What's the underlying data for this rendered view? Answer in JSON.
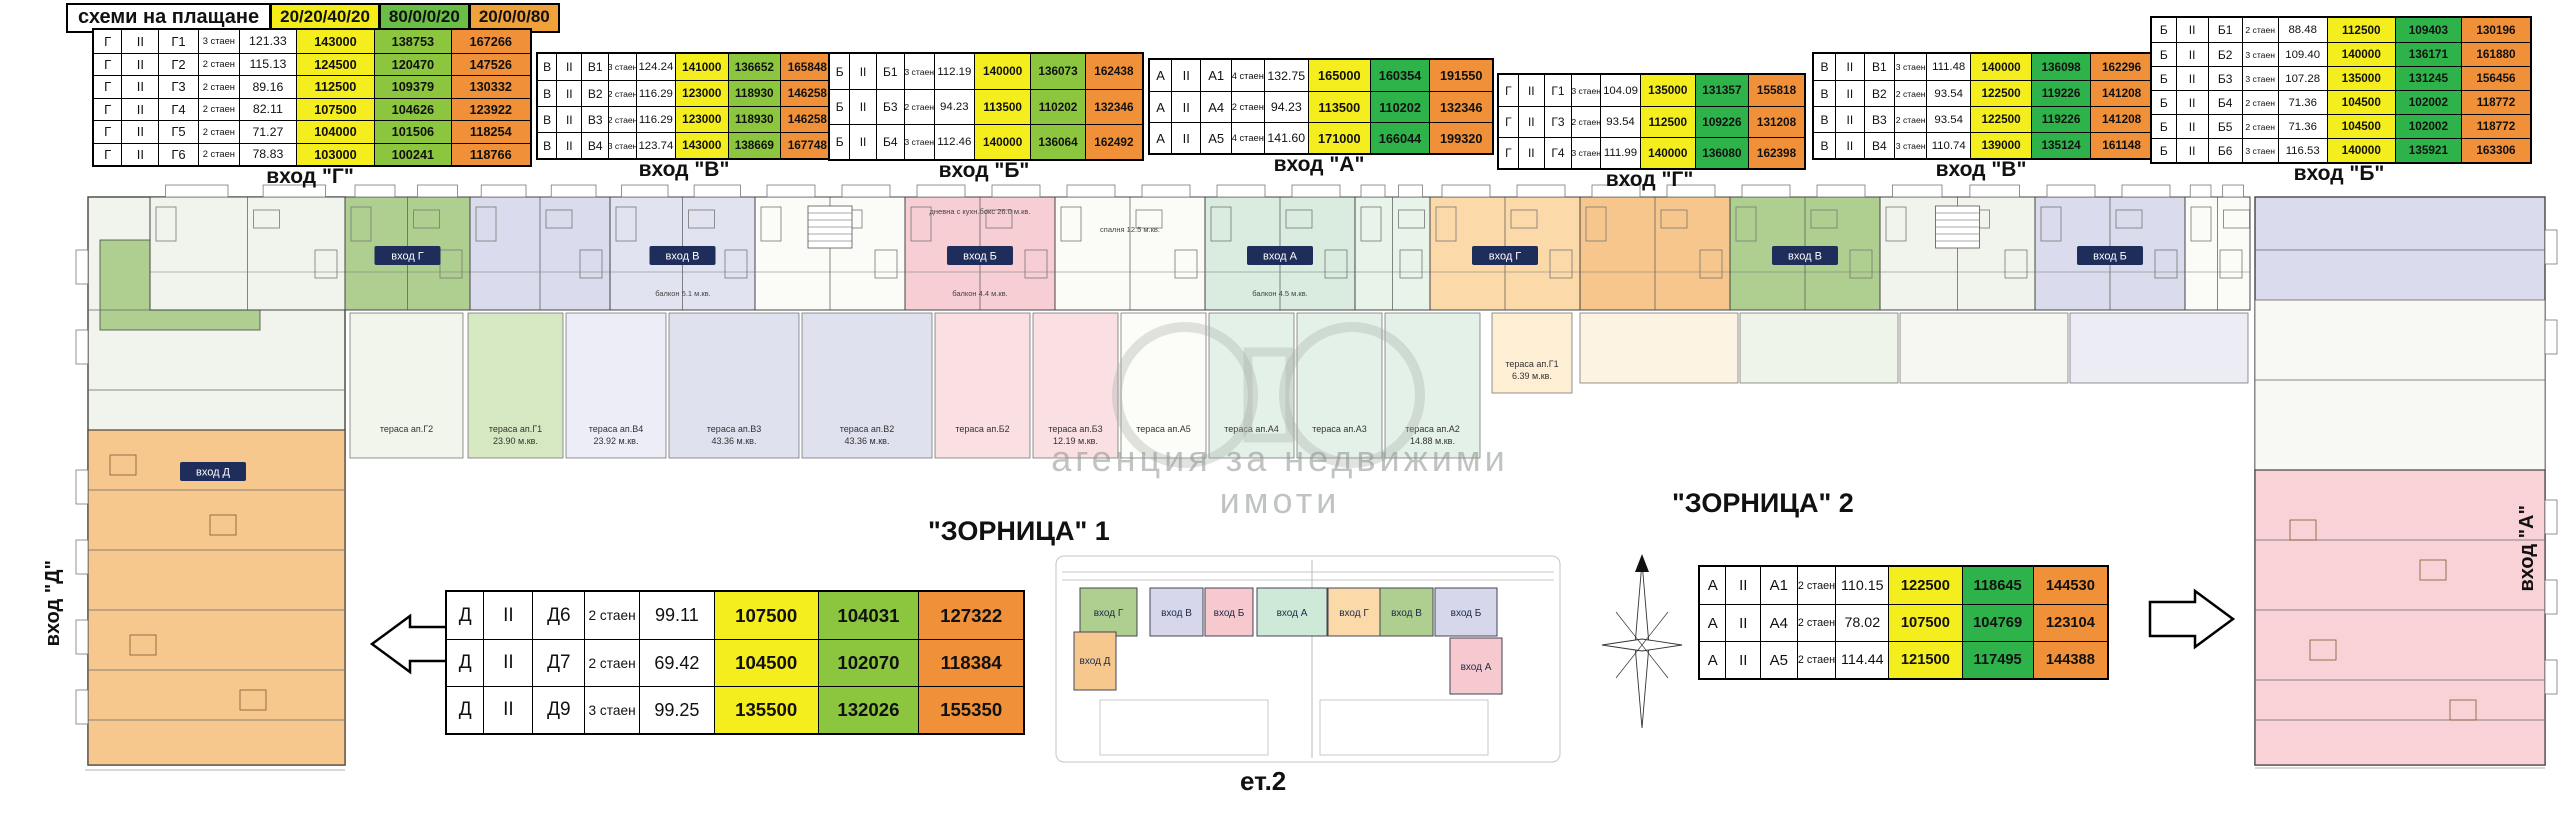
{
  "header": {
    "title": "схеми на плащане",
    "schemes": [
      {
        "label": "20/20/40/20",
        "color": "#f3ec19"
      },
      {
        "label": "80/0/0/20",
        "color": "#6abd45"
      },
      {
        "label": "20/0/0/80",
        "color": "#f0a13a"
      }
    ]
  },
  "colors": {
    "yellow": "#f5ee1e",
    "green_light": "#8cc63f",
    "green_dark": "#2eb34a",
    "orange": "#f0913a",
    "navy": "#1f2d5a"
  },
  "price_tables": [
    {
      "id": "g-left",
      "entrance": "вход \"Г\"",
      "green": "light",
      "x": 92,
      "y": 28,
      "w": 436,
      "row_h": 22.5,
      "fs": 13,
      "rows": [
        [
          "Г",
          "II",
          "Г1",
          "3 стаен",
          "121.33",
          "143000",
          "138753",
          "167266"
        ],
        [
          "Г",
          "II",
          "Г2",
          "2 стаен",
          "115.13",
          "124500",
          "120470",
          "147526"
        ],
        [
          "Г",
          "II",
          "Г3",
          "2 стаен",
          "89.16",
          "112500",
          "109379",
          "130332"
        ],
        [
          "Г",
          "II",
          "Г4",
          "2 стаен",
          "82.11",
          "107500",
          "104626",
          "123922"
        ],
        [
          "Г",
          "II",
          "Г5",
          "2 стаен",
          "71.27",
          "104000",
          "101506",
          "118254"
        ],
        [
          "Г",
          "II",
          "Г6",
          "2 стаен",
          "78.83",
          "103000",
          "100241",
          "118766"
        ]
      ]
    },
    {
      "id": "v-left",
      "entrance": "вход \"В\"",
      "green": "light",
      "x": 536,
      "y": 52,
      "w": 296,
      "row_h": 26,
      "fs": 12,
      "rows": [
        [
          "В",
          "II",
          "В1",
          "3 стаен",
          "124.24",
          "141000",
          "136652",
          "165848"
        ],
        [
          "В",
          "II",
          "В2",
          "2 стаен",
          "116.29",
          "123000",
          "118930",
          "146258"
        ],
        [
          "В",
          "II",
          "В3",
          "2 стаен",
          "116.29",
          "123000",
          "118930",
          "146258"
        ],
        [
          "В",
          "II",
          "В4",
          "3 стаен",
          "123.74",
          "143000",
          "138669",
          "167748"
        ]
      ]
    },
    {
      "id": "b-left",
      "entrance": "вход \"Б\"",
      "green": "light",
      "x": 828,
      "y": 52,
      "w": 312,
      "row_h": 35,
      "fs": 12,
      "rows": [
        [
          "Б",
          "II",
          "Б1",
          "3 стаен",
          "112.19",
          "140000",
          "136073",
          "162438"
        ],
        [
          "Б",
          "II",
          "Б3",
          "2 стаен",
          "94.23",
          "113500",
          "110202",
          "132346"
        ],
        [
          "Б",
          "II",
          "Б4",
          "3 стаен",
          "112.46",
          "140000",
          "136064",
          "162492"
        ]
      ]
    },
    {
      "id": "a-top",
      "entrance": "вход \"А\"",
      "green": "dark",
      "x": 1148,
      "y": 58,
      "w": 342,
      "row_h": 31,
      "fs": 13,
      "rows": [
        [
          "А",
          "II",
          "А1",
          "4 стаен",
          "132.75",
          "165000",
          "160354",
          "191550"
        ],
        [
          "А",
          "II",
          "А4",
          "2 стаен",
          "94.23",
          "113500",
          "110202",
          "132346"
        ],
        [
          "А",
          "II",
          "А5",
          "4 стаен",
          "141.60",
          "171000",
          "166044",
          "199320"
        ]
      ]
    },
    {
      "id": "g-right",
      "entrance": "вход \"Г\"",
      "green": "dark",
      "x": 1497,
      "y": 73,
      "w": 305,
      "row_h": 31,
      "fs": 12,
      "rows": [
        [
          "Г",
          "II",
          "Г1",
          "3 стаен",
          "104.09",
          "135000",
          "131357",
          "155818"
        ],
        [
          "Г",
          "II",
          "Г3",
          "2 стаен",
          "93.54",
          "112500",
          "109226",
          "131208"
        ],
        [
          "Г",
          "II",
          "Г4",
          "3 стаен",
          "111.99",
          "140000",
          "136080",
          "162398"
        ]
      ]
    },
    {
      "id": "v-right",
      "entrance": "вход \"В\"",
      "green": "dark",
      "x": 1812,
      "y": 52,
      "w": 338,
      "row_h": 26,
      "fs": 12,
      "rows": [
        [
          "В",
          "II",
          "В1",
          "3 стаен",
          "111.48",
          "140000",
          "136098",
          "162296"
        ],
        [
          "В",
          "II",
          "В2",
          "2 стаен",
          "93.54",
          "122500",
          "119226",
          "141208"
        ],
        [
          "В",
          "II",
          "В3",
          "2 стаен",
          "93.54",
          "122500",
          "119226",
          "141208"
        ],
        [
          "В",
          "II",
          "В4",
          "3 стаен",
          "110.74",
          "139000",
          "135124",
          "161148"
        ]
      ]
    },
    {
      "id": "b-right",
      "entrance": "вход \"Б\"",
      "green": "dark",
      "x": 2150,
      "y": 16,
      "w": 378,
      "row_h": 24,
      "fs": 12,
      "rows": [
        [
          "Б",
          "II",
          "Б1",
          "2 стаен",
          "88.48",
          "112500",
          "109403",
          "130196"
        ],
        [
          "Б",
          "II",
          "Б2",
          "3 стаен",
          "109.40",
          "140000",
          "136171",
          "161880"
        ],
        [
          "Б",
          "II",
          "Б3",
          "3 стаен",
          "107.28",
          "135000",
          "131245",
          "156456"
        ],
        [
          "Б",
          "II",
          "Б4",
          "2 стаен",
          "71.36",
          "104500",
          "102002",
          "118772"
        ],
        [
          "Б",
          "II",
          "Б5",
          "2 стаен",
          "71.36",
          "104500",
          "102002",
          "118772"
        ],
        [
          "Б",
          "II",
          "Б6",
          "3 стаен",
          "116.53",
          "140000",
          "135921",
          "163306"
        ]
      ]
    },
    {
      "id": "d-bottom",
      "entrance": "",
      "green": "light",
      "x": 445,
      "y": 590,
      "w": 576,
      "row_h": 47,
      "fs": 19,
      "rows": [
        [
          "Д",
          "II",
          "Д6",
          "2 стаен",
          "99.11",
          "107500",
          "104031",
          "127322"
        ],
        [
          "Д",
          "II",
          "Д7",
          "2 стаен",
          "69.42",
          "104500",
          "102070",
          "118384"
        ],
        [
          "Д",
          "II",
          "Д9",
          "3 стаен",
          "99.25",
          "135500",
          "132026",
          "155350"
        ]
      ]
    },
    {
      "id": "a-bottom",
      "entrance": "",
      "green": "dark",
      "x": 1698,
      "y": 565,
      "w": 407,
      "row_h": 37,
      "fs": 15,
      "rows": [
        [
          "А",
          "II",
          "А1",
          "2 стаен",
          "110.15",
          "122500",
          "118645",
          "144530"
        ],
        [
          "А",
          "II",
          "А4",
          "2 стаен",
          "78.02",
          "107500",
          "104769",
          "123104"
        ],
        [
          "А",
          "II",
          "А5",
          "2 стаен",
          "114.44",
          "121500",
          "117495",
          "144388"
        ]
      ]
    }
  ],
  "labels": {
    "zornitsa1": "\"ЗОРНИЦА\" 1",
    "zornitsa2": "\"ЗОРНИЦА\" 2",
    "floor": "ет.2",
    "wing_left": "вход \"Д\"",
    "wing_right": "вход \"А\"",
    "watermark": "агенция за недвижими имоти"
  },
  "plan": {
    "palette": {
      "pale": "#f1f4ec",
      "green": "#aecf90",
      "lavender": "#dadbec",
      "lavender2": "#e2e3f0",
      "white": "#fbfbf8",
      "pink": "#f6ced3",
      "mint": "#d9ecdf",
      "mint2": "#e8f3ea",
      "tan": "#fbd9a8",
      "orange": "#f6c68c",
      "wing_orange": "#f7c88e",
      "wing_pink": "#f8d2d6",
      "line": "#444444"
    },
    "band_segments": [
      {
        "x": 150,
        "w": 195,
        "color": "pale",
        "label": ""
      },
      {
        "x": 345,
        "w": 125,
        "color": "green",
        "label": "вход Г"
      },
      {
        "x": 470,
        "w": 140,
        "color": "lavender",
        "label": ""
      },
      {
        "x": 610,
        "w": 145,
        "color": "lavender2",
        "label": "вход В"
      },
      {
        "x": 755,
        "w": 150,
        "color": "white",
        "label": "",
        "stair": true
      },
      {
        "x": 905,
        "w": 150,
        "color": "pink",
        "label": "вход Б"
      },
      {
        "x": 1055,
        "w": 150,
        "color": "white",
        "label": ""
      },
      {
        "x": 1205,
        "w": 150,
        "color": "mint",
        "label": "вход А"
      },
      {
        "x": 1355,
        "w": 75,
        "color": "mint2",
        "label": ""
      },
      {
        "x": 1430,
        "w": 150,
        "color": "tan",
        "label": "вход Г"
      },
      {
        "x": 1580,
        "w": 150,
        "color": "orange",
        "label": ""
      },
      {
        "x": 1730,
        "w": 150,
        "color": "green",
        "label": "вход В"
      },
      {
        "x": 1880,
        "w": 155,
        "color": "pale",
        "label": "",
        "stair": true
      },
      {
        "x": 2035,
        "w": 150,
        "color": "lavender",
        "label": "вход Б"
      },
      {
        "x": 2185,
        "w": 65,
        "color": "white",
        "label": ""
      }
    ],
    "terraces": [
      {
        "x": 350,
        "w": 113,
        "c": "#f2f5ec",
        "name": "тераса ап.Г2",
        "area": "",
        "h": 145
      },
      {
        "x": 468,
        "w": 95,
        "c": "#d6e8c2",
        "name": "тераса ап.Г1",
        "area": "23.90 м.кв.",
        "h": 145
      },
      {
        "x": 566,
        "w": 100,
        "c": "#ecedf6",
        "name": "тераса ап.В4",
        "area": "23.92 м.кв.",
        "h": 145
      },
      {
        "x": 669,
        "w": 130,
        "c": "#e0e1ef",
        "name": "тераса ап.В3",
        "area": "43.36 м.кв.",
        "h": 145
      },
      {
        "x": 802,
        "w": 130,
        "c": "#e0e1ef",
        "name": "тераса ап.В2",
        "area": "43.36 м.кв.",
        "h": 145
      },
      {
        "x": 935,
        "w": 95,
        "c": "#fadfe3",
        "name": "тераса ап.Б2",
        "area": "",
        "h": 145
      },
      {
        "x": 1033,
        "w": 85,
        "c": "#fadfe3",
        "name": "тераса ап.Б3",
        "area": "12.19 м.кв.",
        "h": 145
      },
      {
        "x": 1121,
        "w": 85,
        "c": "#fcfcf9",
        "name": "тераса ап.А5",
        "area": "",
        "h": 145
      },
      {
        "x": 1209,
        "w": 85,
        "c": "#e4f1e8",
        "name": "тераса ап.А4",
        "area": "",
        "h": 145
      },
      {
        "x": 1297,
        "w": 85,
        "c": "#e4f1e8",
        "name": "тераса ап.А3",
        "area": "",
        "h": 145
      },
      {
        "x": 1385,
        "w": 95,
        "c": "#e4f1e8",
        "name": "тераса ап.А2",
        "area": "14.88 м.кв.",
        "h": 145
      },
      {
        "x": 1492,
        "w": 80,
        "c": "#fdeed4",
        "name": "тераса ап.Г1",
        "area": "6.39 м.кв.",
        "h": 80
      },
      {
        "x": 1580,
        "w": 158,
        "c": "#fdf3e2",
        "name": "",
        "area": "",
        "h": 70
      },
      {
        "x": 1740,
        "w": 158,
        "c": "#eef4e7",
        "name": "",
        "area": "",
        "h": 70
      },
      {
        "x": 1900,
        "w": 168,
        "c": "#f6f6f2",
        "name": "",
        "area": "",
        "h": 70
      },
      {
        "x": 2070,
        "w": 178,
        "c": "#ececf5",
        "name": "",
        "area": "",
        "h": 70
      }
    ],
    "annotations": [
      {
        "x": 683,
        "y": 296,
        "text": "балкон 5.1 м.кв."
      },
      {
        "x": 980,
        "y": 296,
        "text": "балкон 4.4 м.кв."
      },
      {
        "x": 1280,
        "y": 296,
        "text": "балкон 4.5 м.кв."
      },
      {
        "x": 980,
        "y": 214,
        "text": "дневна с кухн.бокс 26.0 м.кв."
      },
      {
        "x": 1130,
        "y": 232,
        "text": "спалня 12.5 м.кв."
      }
    ],
    "wing_entrance_label": "вход Д"
  },
  "site_map": {
    "top_blocks": [
      {
        "label": "вход Г",
        "color": "#aecf90"
      },
      {
        "label": "вход В",
        "color": "#d6d7eb"
      },
      {
        "label": "вход Б",
        "color": "#f6c9ce"
      },
      {
        "label": "вход А",
        "color": "#cfe9d8"
      },
      {
        "label": "вход Г",
        "color": "#fbd9a8"
      },
      {
        "label": "вход В",
        "color": "#aecf90"
      },
      {
        "label": "вход Б",
        "color": "#d6d7eb"
      }
    ],
    "lower_left": {
      "label": "вход Д",
      "color": "#f7c88e"
    },
    "lower_right": {
      "label": "вход А",
      "color": "#f6c9ce"
    }
  }
}
